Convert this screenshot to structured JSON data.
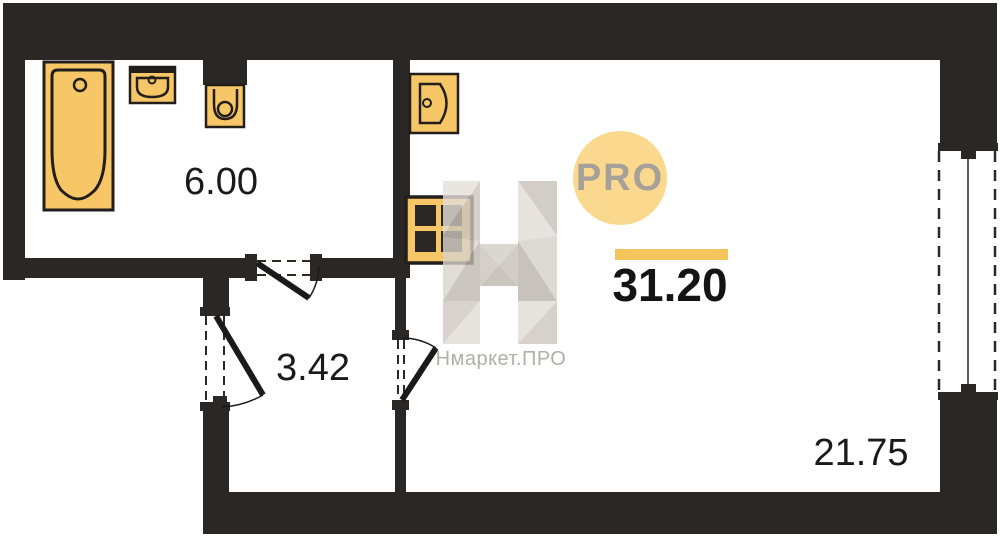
{
  "floor_plan": {
    "rooms": [
      {
        "name": "bathroom",
        "area": "6.00",
        "fixtures": [
          "bathtub-icon",
          "bathroom-sink-icon",
          "toilet-icon"
        ]
      },
      {
        "name": "hallway",
        "area": "3.42",
        "fixtures": []
      },
      {
        "name": "living-room",
        "area": "21.75",
        "fixtures": [
          "kitchen-sink-icon",
          "stove-icon"
        ]
      }
    ],
    "total_area": "31.20",
    "doors": [
      "bathroom-door",
      "entrance-door",
      "living-room-door"
    ],
    "windows": [
      "window-right"
    ]
  },
  "watermark": {
    "badge": "PRO",
    "brand": "Нмаркет.ПРО",
    "letter": "Н"
  },
  "colors": {
    "wall": "#2B2725",
    "fixture_fill": "#F7C666",
    "fixture_stroke": "#221E1B",
    "accent_bar": "#F6C45D",
    "badge_fill": "#FAD98E",
    "badge_text": "#A5A09A",
    "watermark_gray": "#CDC8C1",
    "label_text": "#1A1A1A"
  }
}
